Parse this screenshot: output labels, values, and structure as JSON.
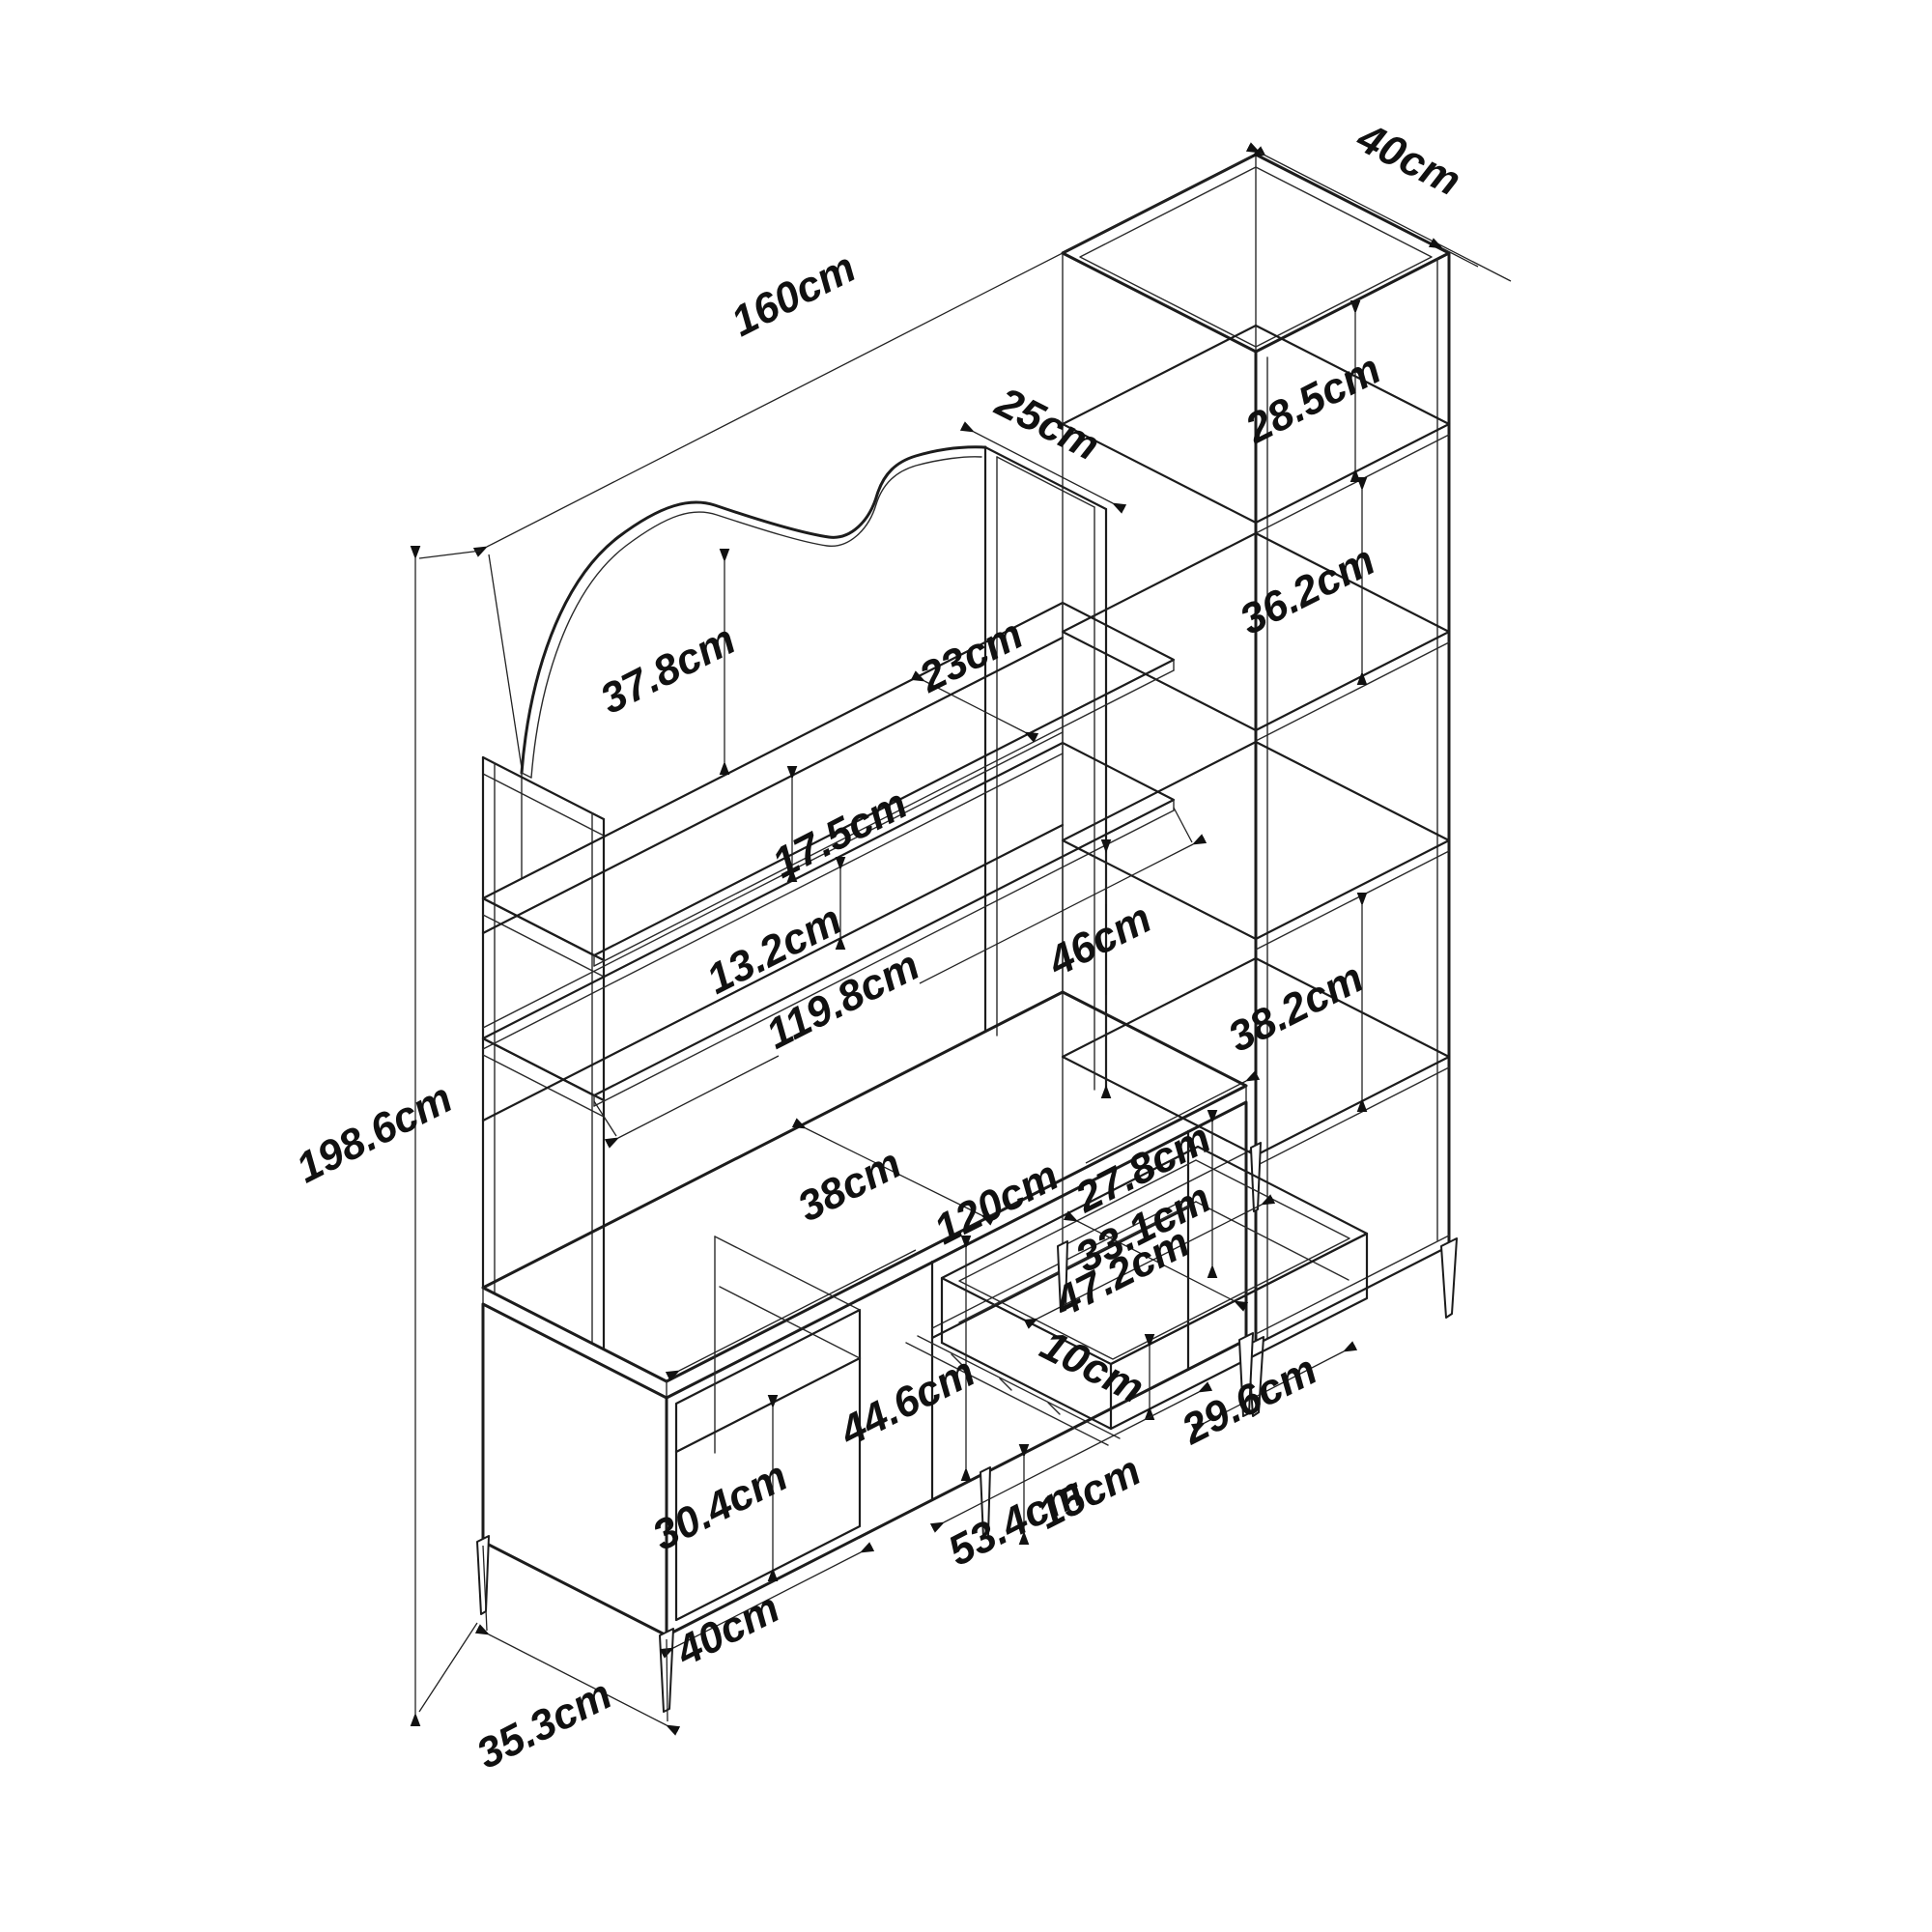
{
  "drawing": {
    "type": "isometric furniture technical drawing",
    "unit": "cm",
    "colors": {
      "line": "#1c1c1c",
      "background": "#ffffff"
    },
    "labels": {
      "total_width": "160cm",
      "total_height": "198.6cm",
      "column_depth": "40cm",
      "hutch_depth": "25cm",
      "column_top_opening_height": "28.5cm",
      "column_mid_opening_height": "36.2cm",
      "column_lower_opening_height": "38.2cm",
      "arch_height": "37.8cm",
      "top_shelf_depth": "23cm",
      "shelf_length": "119.8cm",
      "upper_rail_height": "17.5cm",
      "lower_rail_height": "13.2cm",
      "hutch_clearance_height": "46cm",
      "desk_depth": "38cm",
      "desk_width": "120cm",
      "under_desk_opening_height": "27.8cm",
      "drawer_inner_depth": "33.1cm",
      "drawer_inner_width": "47.2cm",
      "drawer_front_height": "10cm",
      "right_opening_width": "29.6cm",
      "door_section_height": "44.6cm",
      "cubby_opening_height": "30.4cm",
      "cubby_width": "40cm",
      "door_width": "53.4cm",
      "leg_height": "15cm",
      "base_depth": "35.3cm"
    }
  }
}
